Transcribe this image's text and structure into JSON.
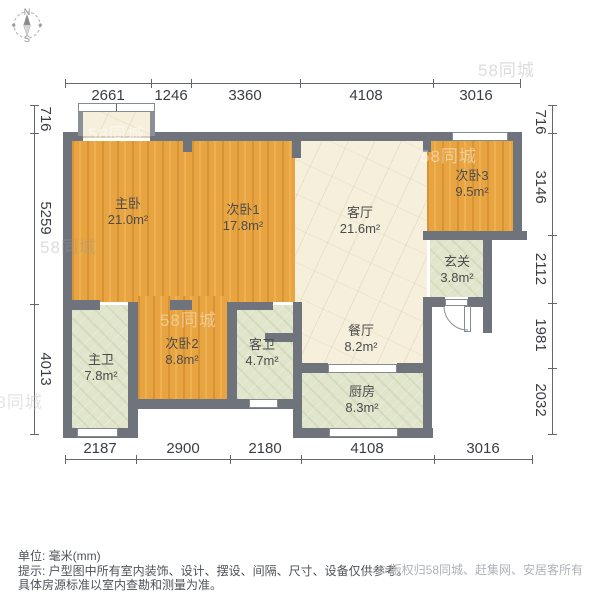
{
  "compass": {
    "north": "N",
    "south": "S"
  },
  "dimensions": {
    "top": [
      "2661",
      "1246",
      "3360",
      "4108",
      "3016"
    ],
    "left": [
      "716",
      "5259",
      "4013"
    ],
    "right": [
      "716",
      "3146",
      "2112",
      "1981",
      "2032"
    ],
    "bottom": [
      "2187",
      "2900",
      "2180",
      "4108",
      "3016"
    ]
  },
  "rooms": [
    {
      "name": "主卧",
      "area": "21.0m²"
    },
    {
      "name": "次卧1",
      "area": "17.8m²"
    },
    {
      "name": "客厅",
      "area": "21.6m²"
    },
    {
      "name": "次卧3",
      "area": "9.5m²"
    },
    {
      "name": "玄关",
      "area": "3.8m²"
    },
    {
      "name": "餐厅",
      "area": "8.2m²"
    },
    {
      "name": "主卫",
      "area": "7.8m²"
    },
    {
      "name": "次卧2",
      "area": "8.8m²"
    },
    {
      "name": "客卫",
      "area": "4.7m²"
    },
    {
      "name": "厨房",
      "area": "8.3m²"
    }
  ],
  "footer": {
    "unit_note": "单位: 毫米(mm)",
    "disclaimer_line1": "提示: 户型图中所有室内装饰、设计、摆设、间隔、尺寸、设备仅供参考。",
    "disclaimer_line2": "具体房源标准以室内查勘和测量为准。",
    "copyright": "© 版权归58同城、赶集网、安居客所有"
  },
  "watermark_text": "58同城",
  "colors": {
    "wood": "#e7a441",
    "marble": "#f6efdc",
    "tile": "#e0e5cb",
    "wall": "#6f747c",
    "background": "#ffffff"
  }
}
